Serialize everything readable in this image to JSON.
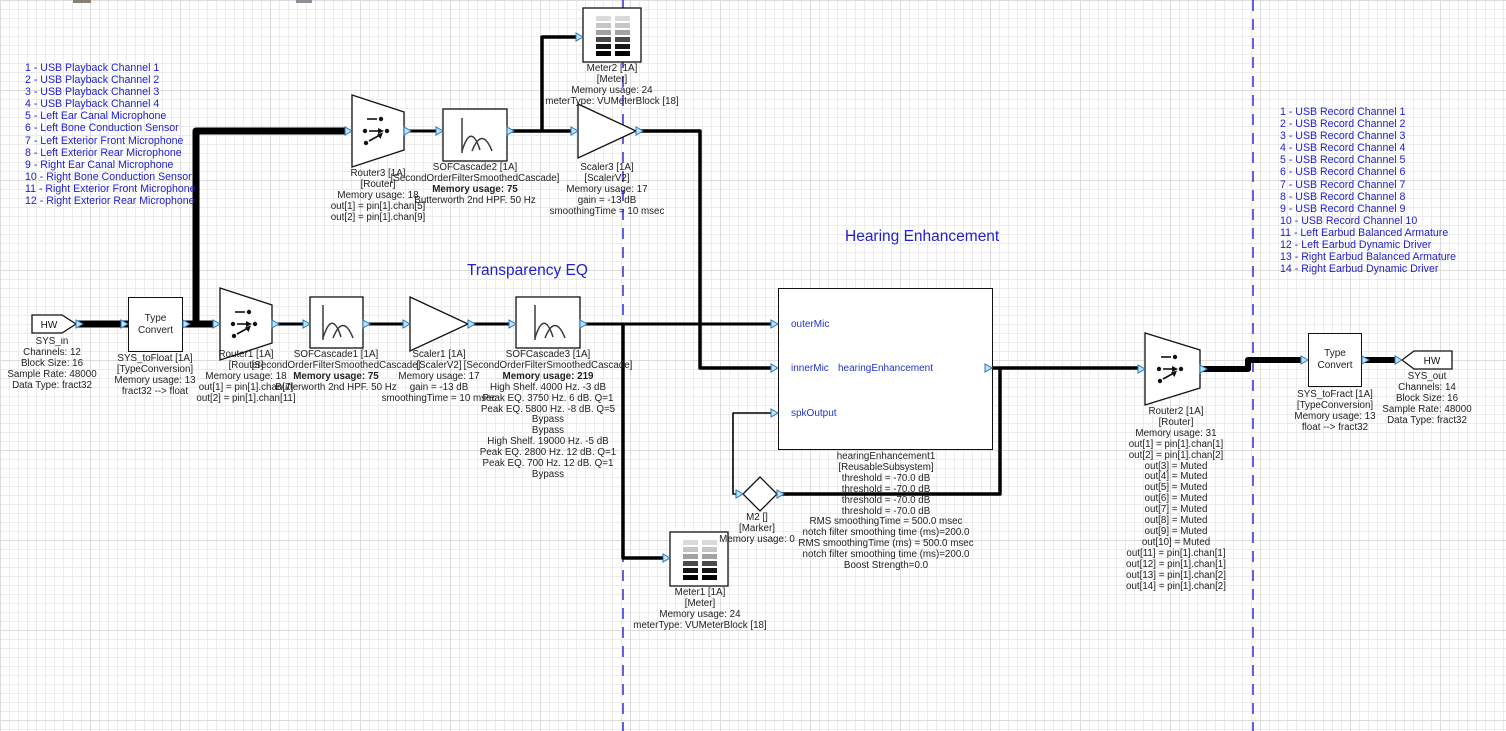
{
  "titles": {
    "transparency_eq": "Transparency EQ",
    "hearing_enhancement": "Hearing Enhancement"
  },
  "channel_lists": {
    "playback": [
      "1 - USB Playback Channel 1",
      "2 - USB Playback Channel 2",
      "3 - USB Playback Channel 3",
      "4 - USB Playback Channel 4",
      "5 - Left Ear Canal Microphone",
      "6 - Left Bone Conduction Sensor",
      "7 - Left Exterior Front Microphone",
      "8 - Left Exterior Rear Microphone",
      "9 - Right Ear Canal Microphone",
      "10 - Right Bone Conduction Sensor",
      "11 - Right Exterior Front Microphone",
      "12 - Right Exterior Rear Microphone"
    ],
    "record": [
      "1 - USB Record Channel 1",
      "2 - USB Record Channel 2",
      "3 - USB Record Channel 3",
      "4 - USB Record Channel 4",
      "5 - USB Record Channel 5",
      "6 - USB Record Channel 6",
      "7 - USB Record Channel 7",
      "8 - USB Record Channel 8",
      "9 - USB Record Channel 9",
      "10 - USB Record Channel 10",
      "11 - Left Earbud Balanced Armature",
      "12 - Left Earbud Dynamic Driver",
      "13 - Right Earbud Balanced Armature",
      "14 - Right Earbud Dynamic Driver"
    ]
  },
  "blocks": {
    "sys_in": {
      "hw_label": "HW",
      "name": "SYS_in",
      "lines": [
        "Channels: 12",
        "Block Size: 16",
        "Sample Rate: 48000",
        "Data Type: fract32"
      ]
    },
    "sys_to_float": {
      "body": "Type Convert",
      "name": "SYS_toFloat [1A]",
      "type": "[TypeConversion]",
      "lines": [
        "Memory usage: 13",
        "fract32 --> float"
      ]
    },
    "router1": {
      "name": "Router1 [1A]",
      "type": "[Router]",
      "lines": [
        "Memory usage: 18",
        "out[1] = pin[1].chan[7]",
        "out[2] = pin[1].chan[11]"
      ]
    },
    "sof1": {
      "name": "SOFCascade1 [1A]",
      "type": "[SecondOrderFilterSmoothedCascade]",
      "memory": "Memory usage: 75",
      "lines": [
        "Butterworth 2nd HPF. 50 Hz"
      ]
    },
    "scaler1": {
      "name": "Scaler1 [1A]",
      "type": "[ScalerV2]",
      "lines": [
        "Memory usage: 17",
        "gain = -13 dB",
        "smoothingTime = 10 msec"
      ]
    },
    "sof3": {
      "name": "SOFCascade3 [1A]",
      "type": "[SecondOrderFilterSmoothedCascade]",
      "memory": "Memory usage: 219",
      "lines": [
        "High Shelf. 4000 Hz. -3 dB",
        "Peak EQ. 3750 Hz. 6 dB. Q=1",
        "Peak EQ. 5800 Hz. -8 dB. Q=5",
        "Bypass",
        "Bypass",
        "High Shelf. 19000 Hz. -5 dB",
        "Peak EQ. 2800 Hz. 12 dB. Q=1",
        "Peak EQ. 700 Hz. 12 dB. Q=1",
        "Bypass"
      ]
    },
    "router3": {
      "name": "Router3 [1A]",
      "type": "[Router]",
      "lines": [
        "Memory usage: 18",
        "out[1] = pin[1].chan[5]",
        "out[2] = pin[1].chan[9]"
      ]
    },
    "sof2": {
      "name": "SOFCascade2 [1A]",
      "type": "[SecondOrderFilterSmoothedCascade]",
      "memory": "Memory usage: 75",
      "lines": [
        "Butterworth 2nd HPF. 50 Hz"
      ]
    },
    "scaler3": {
      "name": "Scaler3 [1A]",
      "type": "[ScalerV2]",
      "lines": [
        "Memory usage: 17",
        "gain = -13 dB",
        "smoothingTime = 10 msec"
      ]
    },
    "meter2": {
      "name": "Meter2 [1A]",
      "type": "[Meter]",
      "lines": [
        "Memory usage: 24",
        "meterType: VUMeterBlock [18]"
      ]
    },
    "meter1": {
      "name": "Meter1 [1A]",
      "type": "[Meter]",
      "lines": [
        "Memory usage: 24",
        "meterType: VUMeterBlock [18]"
      ]
    },
    "hearing": {
      "ports": {
        "in1": "outerMic",
        "in2": "innerMic",
        "in3": "spkOutput"
      },
      "label": "hearingEnhancement",
      "name": "hearingEnhancement1",
      "type": "[ReusableSubsystem]",
      "lines": [
        "threshold = -70.0 dB",
        "threshold = -70.0 dB",
        "threshold = -70.0 dB",
        "threshold = -70.0 dB",
        "RMS smoothingTime = 500.0 msec",
        "notch filter smoothing time (ms)=200.0",
        "RMS smoothingTime (ms) = 500.0 msec",
        "notch filter smoothing time (ms)=200.0",
        "Boost Strength=0.0"
      ]
    },
    "m2": {
      "name": "M2 []",
      "type": "[Marker]",
      "lines": [
        "Memory usage: 0"
      ]
    },
    "router2": {
      "name": "Router2 [1A]",
      "type": "[Router]",
      "lines": [
        "Memory usage: 31",
        "out[1] = pin[1].chan[1]",
        "out[2] = pin[1].chan[2]",
        "out[3] = Muted",
        "out[4] = Muted",
        "out[5] = Muted",
        "out[6] = Muted",
        "out[7] = Muted",
        "out[8] = Muted",
        "out[9] = Muted",
        "out[10] = Muted",
        "out[11] = pin[1].chan[1]",
        "out[12] = pin[1].chan[1]",
        "out[13] = pin[1].chan[2]",
        "out[14] = pin[1].chan[2]"
      ]
    },
    "sys_to_fract": {
      "body": "Type Convert",
      "name": "SYS_toFract [1A]",
      "type": "[TypeConversion]",
      "lines": [
        "Memory usage: 13",
        "float --> fract32"
      ]
    },
    "sys_out": {
      "hw_label": "HW",
      "name": "SYS_out",
      "lines": [
        "Channels: 14",
        "Block Size: 16",
        "Sample Rate: 48000",
        "Data Type: fract32"
      ]
    }
  },
  "colors": {
    "annotation_blue": "#2121cd",
    "boundary_dash_blue": "#3b3bd8",
    "feedback_wire_blue": "#2233cc",
    "port_fill": "#b5eaf5",
    "port_stroke": "#3070c0"
  }
}
